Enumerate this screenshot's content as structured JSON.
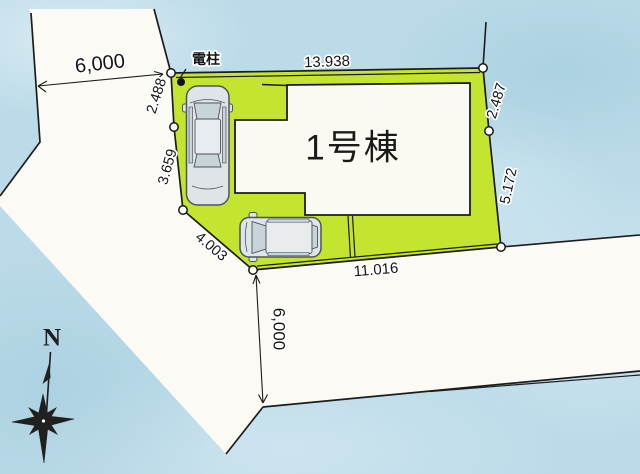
{
  "plan": {
    "pole_label": "電柱",
    "building_label": "1号棟",
    "compass_north": "N",
    "dims": {
      "road_west": "6,000",
      "lot_north": "13.938",
      "lot_west_upper": "2.488",
      "lot_west_lower": "3.659",
      "lot_southwest": "4.003",
      "lot_east_upper": "2.487",
      "lot_east_lower": "5.172",
      "lot_south": "11.016",
      "road_south": "6,000"
    },
    "colors": {
      "background": "#bcdbe9",
      "road": "#fbfaf4",
      "lot": "#c3e52f",
      "building": "#fbfaf2",
      "line": "#1c1c1c"
    }
  }
}
